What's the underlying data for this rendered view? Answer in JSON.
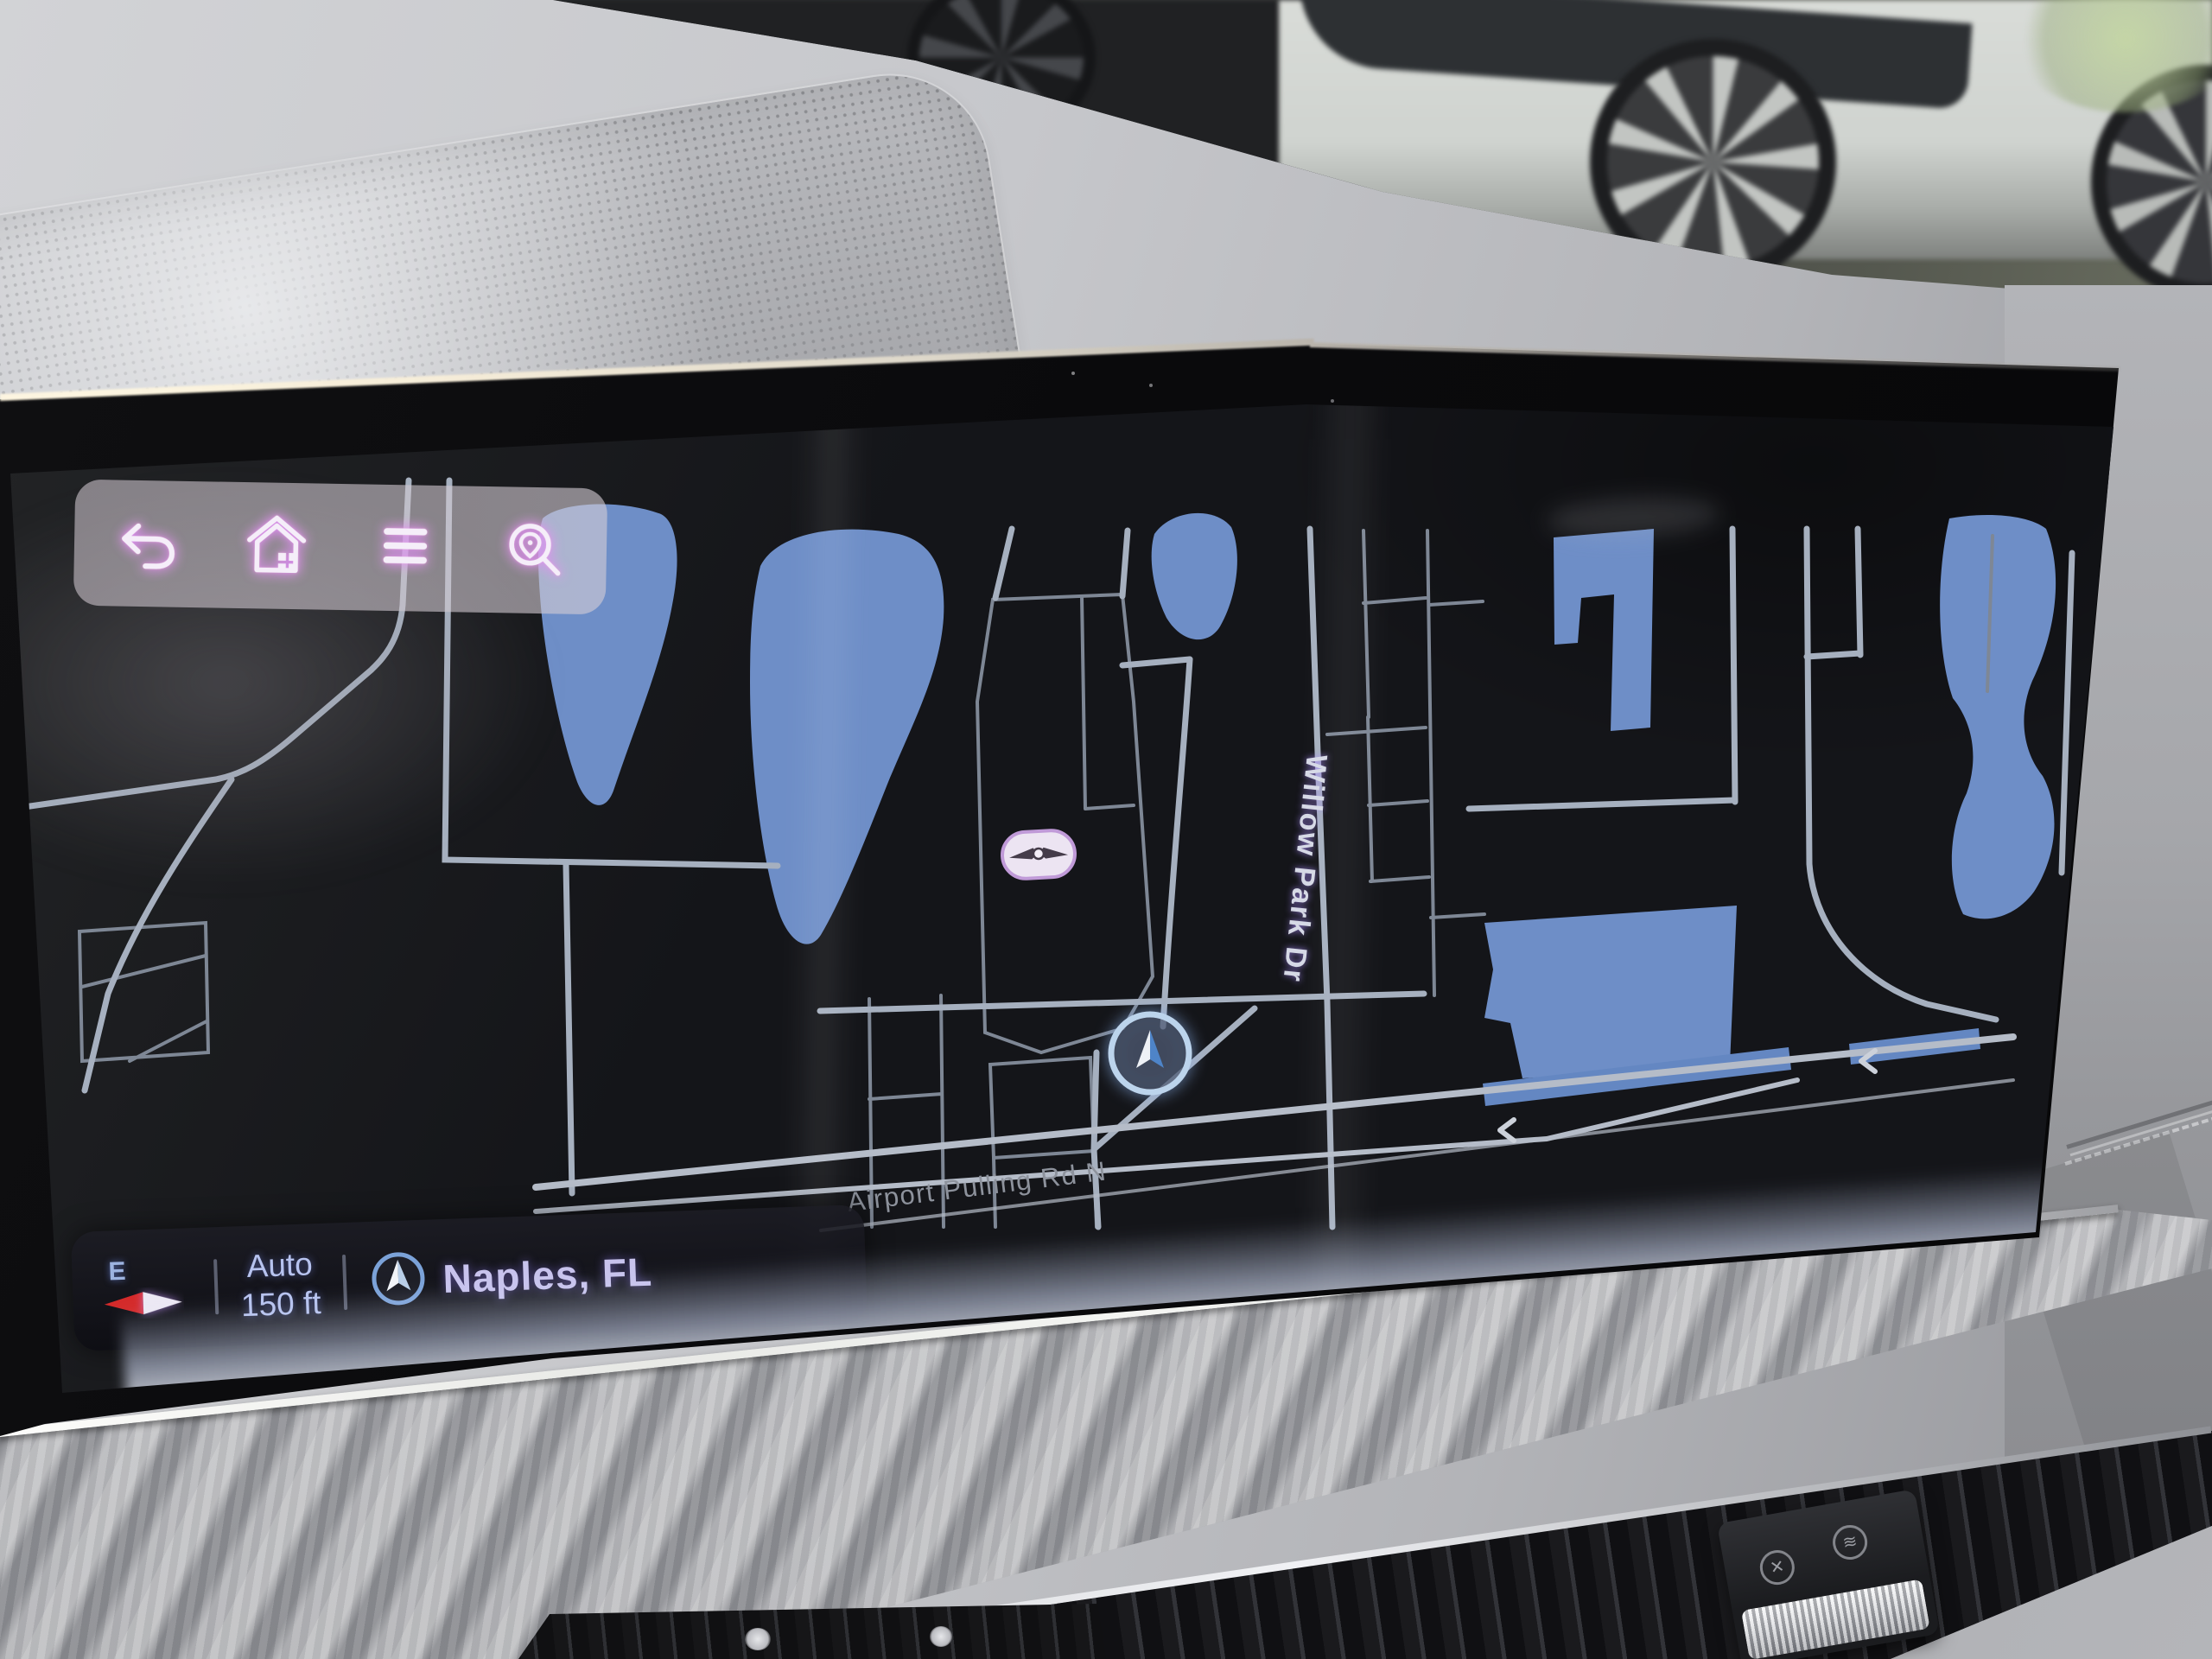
{
  "device": {
    "type": "car infotainment navigation display",
    "accent_colors": {
      "water": "#6e8ec7",
      "road": "#a6b0bf",
      "map_background": "#141519",
      "icon_glow": "#d082ff",
      "status_text": "#b7c3ef"
    }
  },
  "toolbar": {
    "items": [
      {
        "icon": "back-icon"
      },
      {
        "icon": "home-icon"
      },
      {
        "icon": "menu-icon"
      },
      {
        "icon": "search-location-icon"
      }
    ]
  },
  "map": {
    "labels": {
      "street_vertical": "Willow Park Dr",
      "street_bottom": "Airport Pulling Rd N"
    },
    "markers": {
      "vehicle_brand_marker": "genesis-logo-pill",
      "position_marker": "navigation-arrow"
    },
    "road_direction_arrows": "left-chevrons"
  },
  "status_bar": {
    "compass": {
      "direction": "E",
      "icon": "compass-needle-icon"
    },
    "scale": {
      "mode": "Auto",
      "value": "150 ft"
    },
    "location": {
      "icon": "nav-arrow-icon",
      "name": "Naples, FL"
    }
  }
}
